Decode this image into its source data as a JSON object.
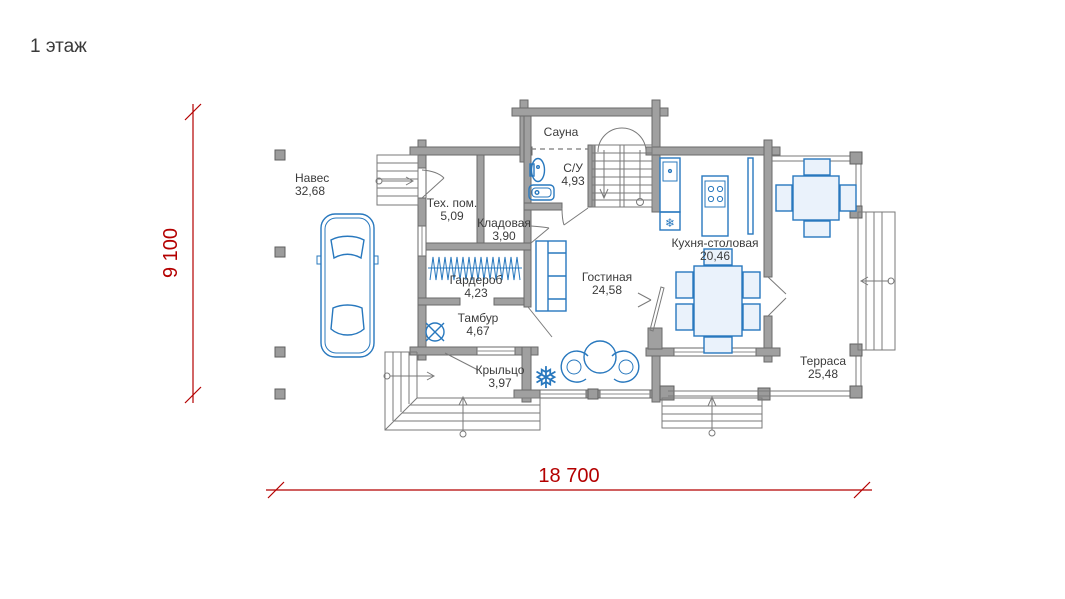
{
  "floor_title": "1 этаж",
  "dimensions": {
    "vertical": "9 100",
    "horizontal": "18 700"
  },
  "rooms": {
    "naves": {
      "name": "Навес",
      "area": "32,68"
    },
    "teh_pom": {
      "name": "Тех. пом.",
      "area": "5,09"
    },
    "kladovaya": {
      "name": "Кладовая",
      "area": "3,90"
    },
    "sauna": {
      "name": "Сауна"
    },
    "su": {
      "name": "С/У",
      "area": "4,93"
    },
    "garderob": {
      "name": "Гардероб",
      "area": "4,23"
    },
    "tambur": {
      "name": "Тамбур",
      "area": "4,67"
    },
    "gostinaya": {
      "name": "Гостиная",
      "area": "24,58"
    },
    "kuhnya": {
      "name": "Кухня-столовая",
      "area": "20,46"
    },
    "kryltso": {
      "name": "Крыльцо",
      "area": "3,97"
    },
    "terrasa": {
      "name": "Терраса",
      "area": "25,48"
    }
  },
  "icons": {
    "fridge": "❄",
    "plant": "❅"
  },
  "colors": {
    "wall": "#a0a0a0",
    "furniture": "#2878be",
    "dimension": "#b40000",
    "label_text": "#3c3c3c",
    "background": "#ffffff"
  }
}
